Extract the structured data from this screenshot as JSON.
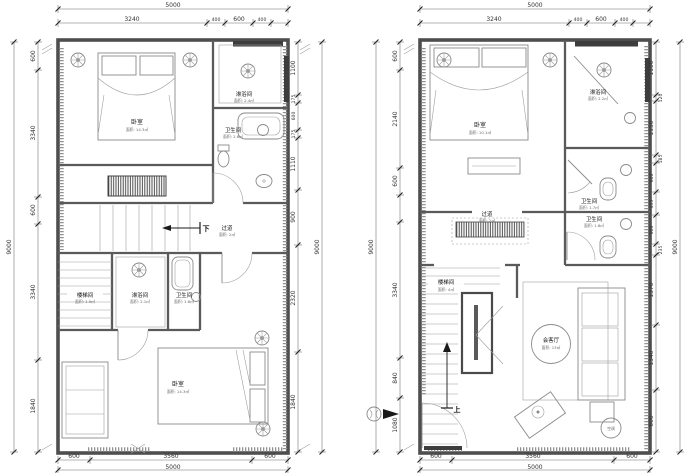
{
  "left_plan": {
    "dims": {
      "top_total": "5000",
      "top": [
        "3240",
        "400",
        "600",
        "400"
      ],
      "left": [
        "600",
        "3340",
        "600",
        "3340",
        "1840"
      ],
      "left_total": "9000",
      "right": [
        "1100",
        "175",
        "600",
        "175",
        "1110",
        "900",
        "2320",
        "1840"
      ],
      "right_total": "9000",
      "bottom": [
        "600",
        "3560",
        "600"
      ],
      "bottom_total": "5000"
    },
    "rooms": {
      "bedroom_top": {
        "name": "卧室",
        "area": "面积: 14.3㎡"
      },
      "shower_top": {
        "name": "淋浴间",
        "area": "面积: 2.4㎡"
      },
      "bath_top": {
        "name": "卫生间",
        "area": "面积: 2.6㎡"
      },
      "corridor": {
        "name": "过道",
        "area": "面积: 2㎡"
      },
      "down_label": "下",
      "stairwell": {
        "name": "楼梯间",
        "area": "面积: 1.9㎡"
      },
      "shower_mid": {
        "name": "淋浴间",
        "area": "面积: 2.1㎡"
      },
      "bath_mid": {
        "name": "卫生间",
        "area": "面积: 1.6㎡"
      },
      "bedroom_bottom": {
        "name": "卧室",
        "area": "面积: 14.3㎡"
      }
    }
  },
  "right_plan": {
    "dims": {
      "top_total": "5000",
      "top": [
        "3240",
        "400",
        "600",
        "400"
      ],
      "left": [
        "600",
        "2140",
        "600",
        "3340",
        "840",
        "1080"
      ],
      "left_total": "9000",
      "right": [
        "1100",
        "120",
        "1150",
        "185",
        "600",
        "455",
        "600",
        "235",
        "1370",
        "1340",
        "600"
      ],
      "right_total": "9000",
      "bottom": [
        "600",
        "3560",
        "600"
      ],
      "bottom_total": "5000"
    },
    "rooms": {
      "bedroom": {
        "name": "卧室",
        "area": "面积: 10.1㎡"
      },
      "shower": {
        "name": "淋浴间",
        "area": "面积: 2.2㎡"
      },
      "bath_a": {
        "name": "卫生间",
        "area": "面积: 1.7㎡"
      },
      "bath_b": {
        "name": "卫生间",
        "area": "面积: 1.8㎡"
      },
      "corridor": {
        "name": "过道",
        "area": "面积: 2㎡"
      },
      "stairwell": {
        "name": "楼梯间",
        "area": "面积: 4㎡"
      },
      "living": {
        "name": "会客厅",
        "area": "面积: 13㎡"
      },
      "ac_label": "空调",
      "up_label": "上"
    }
  }
}
